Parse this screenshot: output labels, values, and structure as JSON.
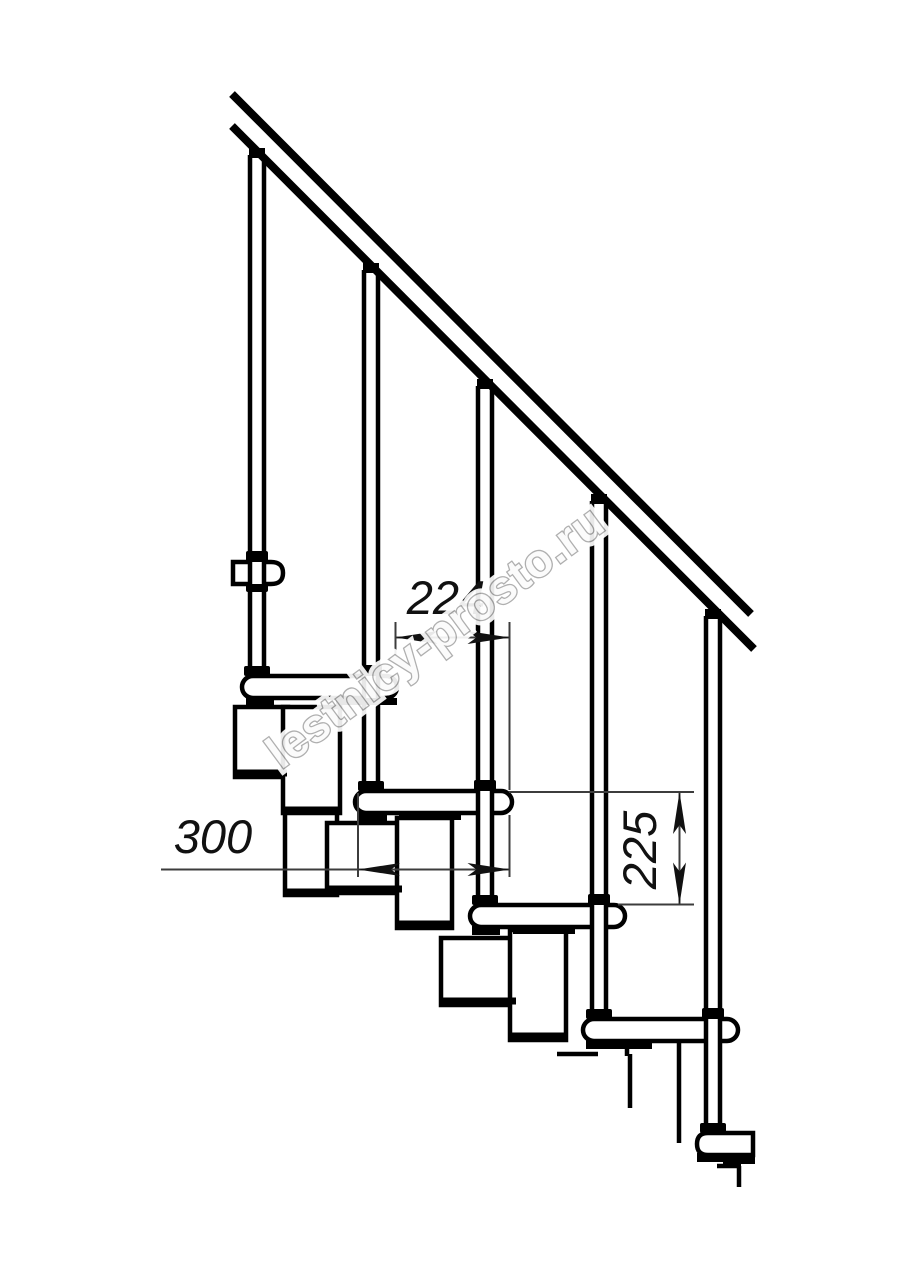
{
  "drawing": {
    "title": "modular-staircase-side-section",
    "dimensions": {
      "step_run": "224",
      "tread_depth": "300",
      "riser_height": "225"
    },
    "watermark": "lestnicy-prosto.ru",
    "colors": {
      "background": "#ffffff",
      "line": "#000000",
      "dimension": "#3c3c3c",
      "watermark_outline": "#a9a9a9",
      "watermark_fill": "#fbfbfb"
    }
  }
}
